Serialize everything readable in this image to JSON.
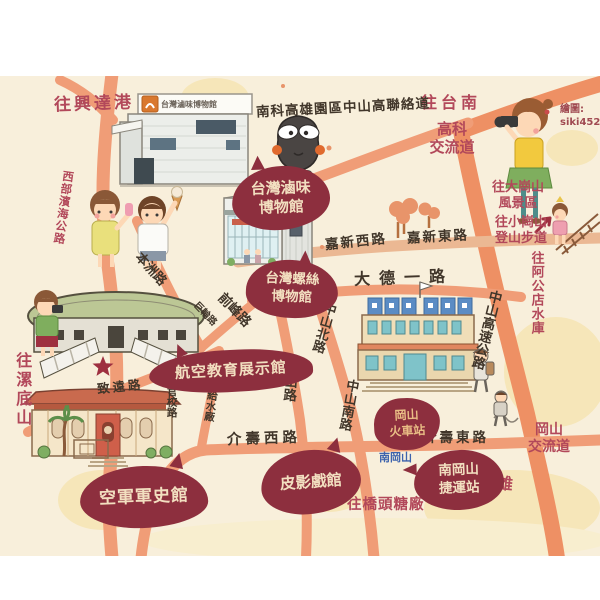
{
  "canvas": {
    "bg_map": "#f8efdb",
    "bg_margin": "#ffffff"
  },
  "colors": {
    "road": "#f09d77",
    "road_minor": "#ebb893",
    "highway": "#ee9064",
    "bubble": "#8d2f3e",
    "bubble_text": "#f2dfc0",
    "bubble_text_warm": "#e9bd85",
    "direction_text": "#b2485a",
    "road_text": "#41362a",
    "station_text_blue": "#3d63ad",
    "hill": "#f6e3ae",
    "tree": "#e8946a",
    "star": "#9e3040"
  },
  "credit": {
    "label": "繪圖:",
    "handle": "siki4520"
  },
  "signs": {
    "luwei_building_sign": "台灣滷味博物館"
  },
  "direction_labels": {
    "xingda": "往興達港",
    "tainan": "往台南",
    "gaoke_l1": "高科",
    "gaoke_l2": "交流道",
    "dagangshan_l1": "往大崗山",
    "dagangshan_l2": "風景區",
    "xiaogangshan_l1": "往小崗山",
    "xiaogangshan_l2": "登山步道",
    "agongdian": "往阿公店水庫",
    "gangshan_ic_l1": "岡山",
    "gangshan_ic_l2": "交流道",
    "kaohsiung": "往高雄",
    "qiaotou": "往橋頭糖廠",
    "tadishan": "往漯底山",
    "coastal": "西部濱海公路"
  },
  "road_labels": {
    "link_road": "南科高雄園區中山高聯絡道",
    "jiaxin_w": "嘉新西路",
    "jiaxin_e": "嘉新東路",
    "dade": "大德一路",
    "zhongshan_n": "中山北路",
    "zhongshan_s": "中山南路",
    "gangshan_rd": "岡山路",
    "jieshou_w": "介壽西路",
    "jieshou_e": "介壽東路",
    "freeway": "中山高速公路",
    "benzhou": "本洲路",
    "qianfeng": "前峰路",
    "julun": "巨輪路",
    "zhiyuan": "致遠路",
    "jishui": "給水廠",
    "guanxiao": "官校路"
  },
  "pois": {
    "luwei_l1": "台灣滷味",
    "luwei_l2": "博物館",
    "screw_l1": "台灣螺絲",
    "screw_l2": "博物館",
    "aviation": "航空教育展示館",
    "airforce": "空軍軍史館",
    "train_l1": "岡山",
    "train_l2": "火車站",
    "mrt_l1": "南岡山",
    "mrt_l2": "捷運站",
    "shadow": "皮影戲館"
  },
  "station": {
    "nangangshan": "南岡山"
  }
}
